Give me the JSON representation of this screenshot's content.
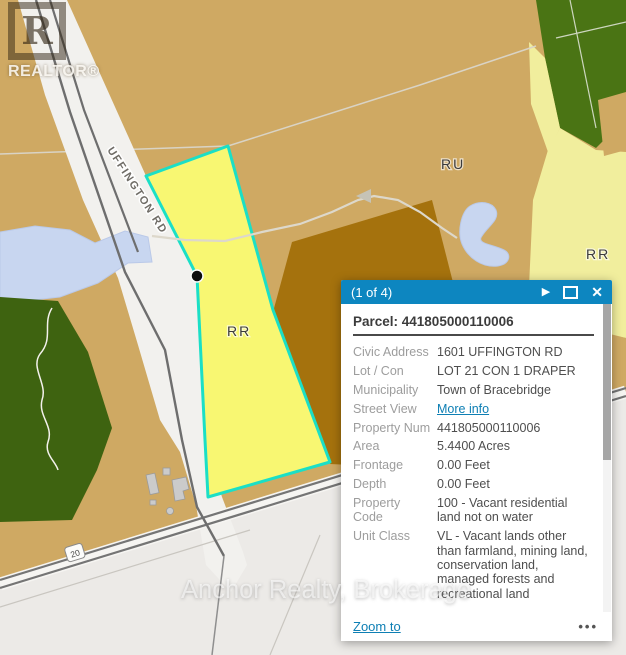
{
  "map": {
    "labels": {
      "road": "UFFINGTON RD",
      "zone_ru": "RU",
      "zone_rr_parcel": "RR",
      "zone_rr_east": "RR",
      "route_shield": "20"
    },
    "watermark_logo": {
      "letter": "R",
      "text": "REALTOR®"
    },
    "watermark_text": "Anchor Realty, Brokerage",
    "colors": {
      "land_tan": "#cfa963",
      "land_brown": "#a5720d",
      "selected_parcel_fill": "#f8f772",
      "selected_parcel_outline": "#1bdfc6",
      "zone_pale_yellow": "#f1ee9d",
      "forest_green": "#4a7414",
      "forest_green_dark": "#3e6310",
      "water_blue": "#c8d6f0",
      "road_gray": "#6e6e6e",
      "base_gray": "#eceae7",
      "popup_header_blue": "#0d86c0",
      "link_blue": "#0e7fb4"
    }
  },
  "popup": {
    "header": {
      "title": "(1 of 4)"
    },
    "icons": {
      "next_icon": "▶",
      "close_icon": "✕"
    },
    "parcel_title": "Parcel: 441805000110006",
    "rows": [
      {
        "label": "Civic Address",
        "value": "1601 UFFINGTON RD"
      },
      {
        "label": "Lot / Con",
        "value": "LOT 21 CON 1 DRAPER"
      },
      {
        "label": "Municipality",
        "value": "Town of Bracebridge"
      },
      {
        "label": "Street View",
        "value": "More info"
      },
      {
        "label": "Property Num",
        "value": "441805000110006"
      },
      {
        "label": "Area",
        "value": "5.4400 Acres"
      },
      {
        "label": "Frontage",
        "value": "0.00 Feet"
      },
      {
        "label": "Depth",
        "value": "0.00 Feet"
      },
      {
        "label": "Property Code",
        "value": "100 - Vacant residential land not on water"
      },
      {
        "label": "Unit Class",
        "value": "VL - Vacant lands other than farmland, mining land, conservation land, managed forests and recreational land"
      }
    ],
    "footer": {
      "zoom_to": "Zoom to",
      "more_actions": "•••"
    }
  }
}
